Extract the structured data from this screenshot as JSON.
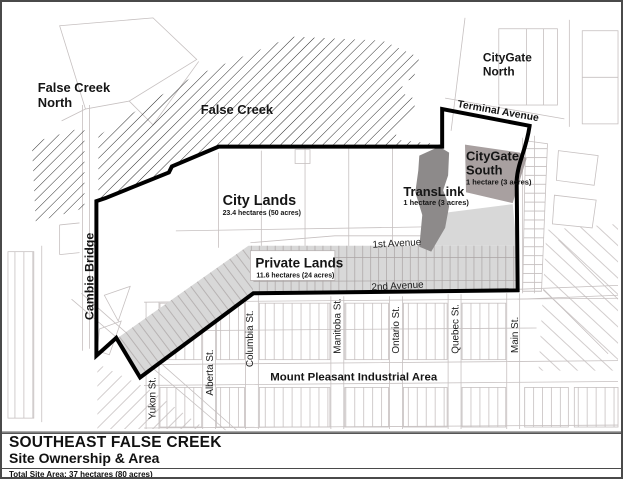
{
  "map": {
    "region_labels": {
      "false_creek_north": {
        "line1": "False Creek",
        "line2": "North"
      },
      "false_creek": "False Creek",
      "citygate_north": {
        "line1": "CityGate",
        "line2": "North"
      },
      "citygate_south": {
        "line1": "CityGate",
        "line2": "South",
        "area": "1 hectare (3 acres)"
      },
      "translink": {
        "name": "TransLink",
        "area": "1 hectare (3 acres)"
      },
      "city_lands": {
        "name": "City Lands",
        "area": "23.4 hectares (50 acres)"
      },
      "private_lands": {
        "name": "Private Lands",
        "area": "11.6 hectares (24 acres)"
      },
      "mount_pleasant": "Mount Pleasant Industrial Area"
    },
    "street_labels": {
      "terminal_avenue": "Terminal Avenue",
      "first_avenue": "1st Avenue",
      "second_avenue": "2nd Avenue",
      "cambie_bridge": "Cambie Bridge",
      "yukon": "Yukon St.",
      "alberta": "Alberta St.",
      "columbia": "Columbia St.",
      "manitoba": "Manitoba St.",
      "ontario": "Ontario St.",
      "quebec": "Quebec St.",
      "main": "Main St."
    },
    "colors": {
      "water_hatch": "#2b2b2b",
      "private_lands_fill": "#d8d8d8",
      "translink_fill": "#8d8a8a",
      "citygate_south_fill": "#a8a0a0",
      "boundary": "#000000",
      "parcel_line": "#c6c0c0"
    }
  },
  "title_block": {
    "title": "SOUTHEAST FALSE CREEK",
    "subtitle": "Site Ownership & Area",
    "total_site_area": "Total Site Area: 37 hectares (80 acres)"
  }
}
